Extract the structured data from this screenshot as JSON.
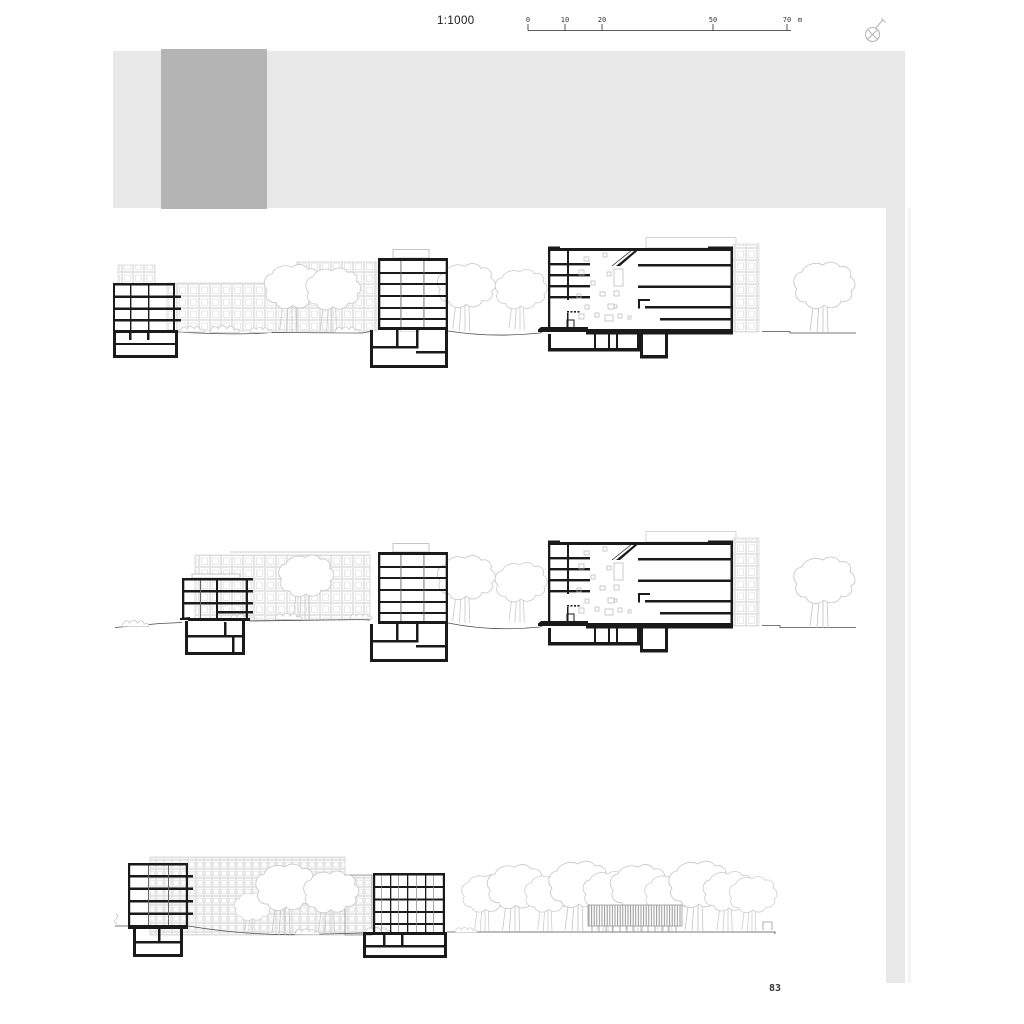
{
  "header": {
    "scale_label": "1:1000",
    "scale_bar": {
      "ticks": [
        "0",
        "10",
        "20",
        "50",
        "70"
      ],
      "unit": "m"
    },
    "icon": "drafting-pen-icon"
  },
  "masthead": {
    "band_color": "#e8e8e8",
    "block_color": "#b4b4b4",
    "strip_color": "#e8e8e8"
  },
  "drawing": {
    "ink_color": "#1a1a1a",
    "elevation_gray": "#cfcfcf",
    "tree_gray": "#c6c6c6",
    "terrain_color": "#4d4d4d",
    "rows": [
      {
        "name": "site-section-1"
      },
      {
        "name": "site-section-2"
      },
      {
        "name": "site-section-3"
      }
    ]
  },
  "page": {
    "number": "83"
  }
}
